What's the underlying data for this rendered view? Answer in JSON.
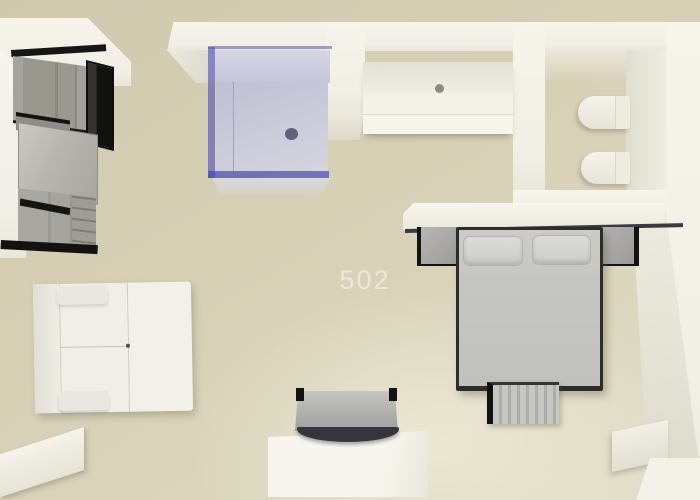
{
  "scene": {
    "title": "3D top-down floor plan render of studio apartment",
    "unit_label": "502"
  },
  "rooms": {
    "bathroom": {
      "items": [
        "shower-enclosure",
        "bathtub",
        "toilet",
        "bidet"
      ]
    },
    "kitchen": {
      "items": [
        "upper-cabinets",
        "countertop",
        "lower-cabinets"
      ]
    },
    "bedroom": {
      "items": [
        "headboard-ledge",
        "nightstand-left",
        "nightstand-right",
        "double-bed",
        "pillow-left",
        "pillow-right",
        "foot-bench"
      ]
    },
    "living_area": {
      "items": [
        "sofa",
        "tv",
        "tv-cabinet"
      ]
    }
  },
  "palette": {
    "floor": "#d6d0b5",
    "floor_highlight": "#e6e2cd",
    "wall": "#f4f2e9",
    "glass_edge": "#5050bb",
    "glass_fill": "#aaaedb",
    "shower_tray": "#c6c8da",
    "furniture_gray": "#c6c6c2",
    "cabinet_gray": "#9c9b93",
    "dark_trim": "#141412",
    "label_text": "#eeeadc"
  }
}
